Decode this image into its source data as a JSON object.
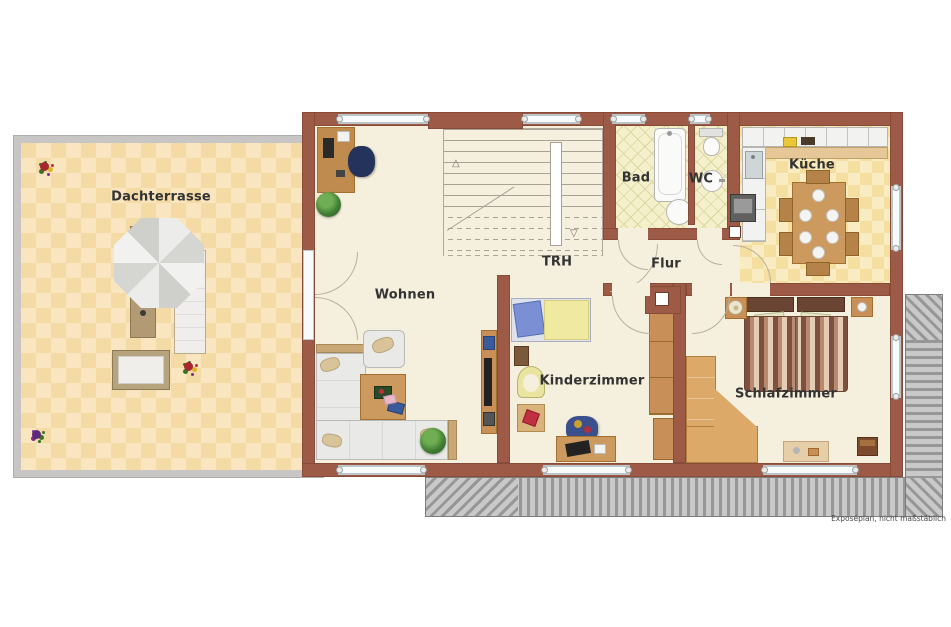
{
  "plan": {
    "footnote": "Exposéplan, nicht maßstäblich"
  },
  "rooms": {
    "dachterrasse": "Dachterrasse",
    "wohnen": "Wohnen",
    "trh": "TRH",
    "bad": "Bad",
    "wc": "WC",
    "kueche": "Küche",
    "flur": "Flur",
    "kinderzimmer": "Kinderzimmer",
    "schlafzimmer": "Schlafzimmer"
  },
  "stairs": {
    "up_arrow": "△",
    "down_arrow": "▽"
  },
  "colors": {
    "wall": "#9d5a46",
    "floor": "#f5efdd",
    "terrace_tile_light": "#f9e6c0",
    "terrace_tile_dark": "#f4dba6",
    "terrace_border": "#c8c6c4",
    "bath_tile": "#f4f0cc",
    "kitchen_tile_light": "#f9ecc2",
    "kitchen_tile_dark": "#f5dfa0",
    "roof_hatch_light": "#c9c9c9",
    "roof_hatch_dark": "#979797",
    "wood": "#cc9a5e",
    "label_text": "#333333"
  }
}
